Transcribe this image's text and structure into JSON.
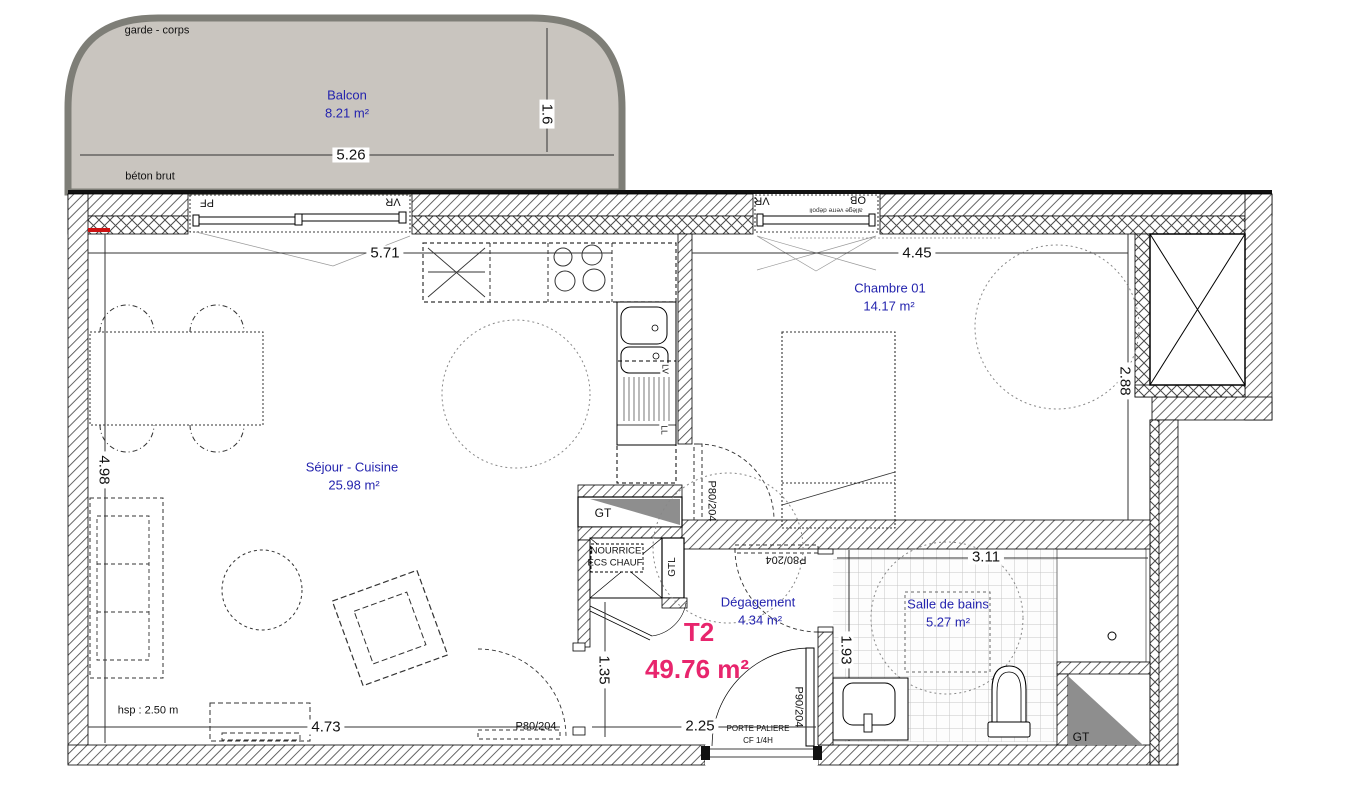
{
  "apartment": {
    "type_label": "T2",
    "total_area": "49.76 m²"
  },
  "rooms": {
    "balcon": {
      "name": "Balcon",
      "area": "8.21 m²"
    },
    "sejour": {
      "name": "Séjour - Cuisine",
      "area": "25.98 m²"
    },
    "chambre": {
      "name": "Chambre 01",
      "area": "14.17 m²"
    },
    "salle_de_bains": {
      "name": "Salle de bains",
      "area": "5.27 m²"
    },
    "degagement": {
      "name": "Dégagement",
      "area": "4.34 m²"
    }
  },
  "dimensions": {
    "balcon_width": "5.26",
    "balcon_depth": "1.6",
    "sejour_width": "5.71",
    "sejour_height": "4.98",
    "sejour_bottom": "4.73",
    "chambre_width": "4.45",
    "chambre_height": "2.88",
    "sdb_width": "3.11",
    "sdb_height": "1.93",
    "entree_width": "2.25",
    "passage": "1.35"
  },
  "annotations": {
    "garde_corps": "garde - corps",
    "beton_brut": "béton brut",
    "hsp": "hsp : 2.50 m",
    "allege": "allège verre dépoli"
  },
  "doors": {
    "chambre": "P80/204",
    "salle_de_bains": "P80/204",
    "sejour": "P80/204",
    "entree": "P90/204",
    "entree_type_1": "PORTE PALIERE",
    "entree_type_2": "CF 1/4H"
  },
  "windows": {
    "pf": "PF",
    "vr_sejour": "VR",
    "vr_chambre": "VR",
    "ob": "OB"
  },
  "technical": {
    "gt_1": "GT",
    "gt_2": "GT",
    "gtl": "GTL",
    "nourrice_line1": "NOURRICE",
    "nourrice_line2": "ECS CHAUF",
    "lv": "LV",
    "ll": "LL"
  },
  "colors": {
    "room_label_blue": "#2424ae",
    "total_area_pink": "#e8256d",
    "balcony_fill": "#c9c5bf",
    "balcony_rail": "#7e7e77",
    "triangle_gray": "#8e8e8e",
    "red_mark": "#cc1111"
  }
}
